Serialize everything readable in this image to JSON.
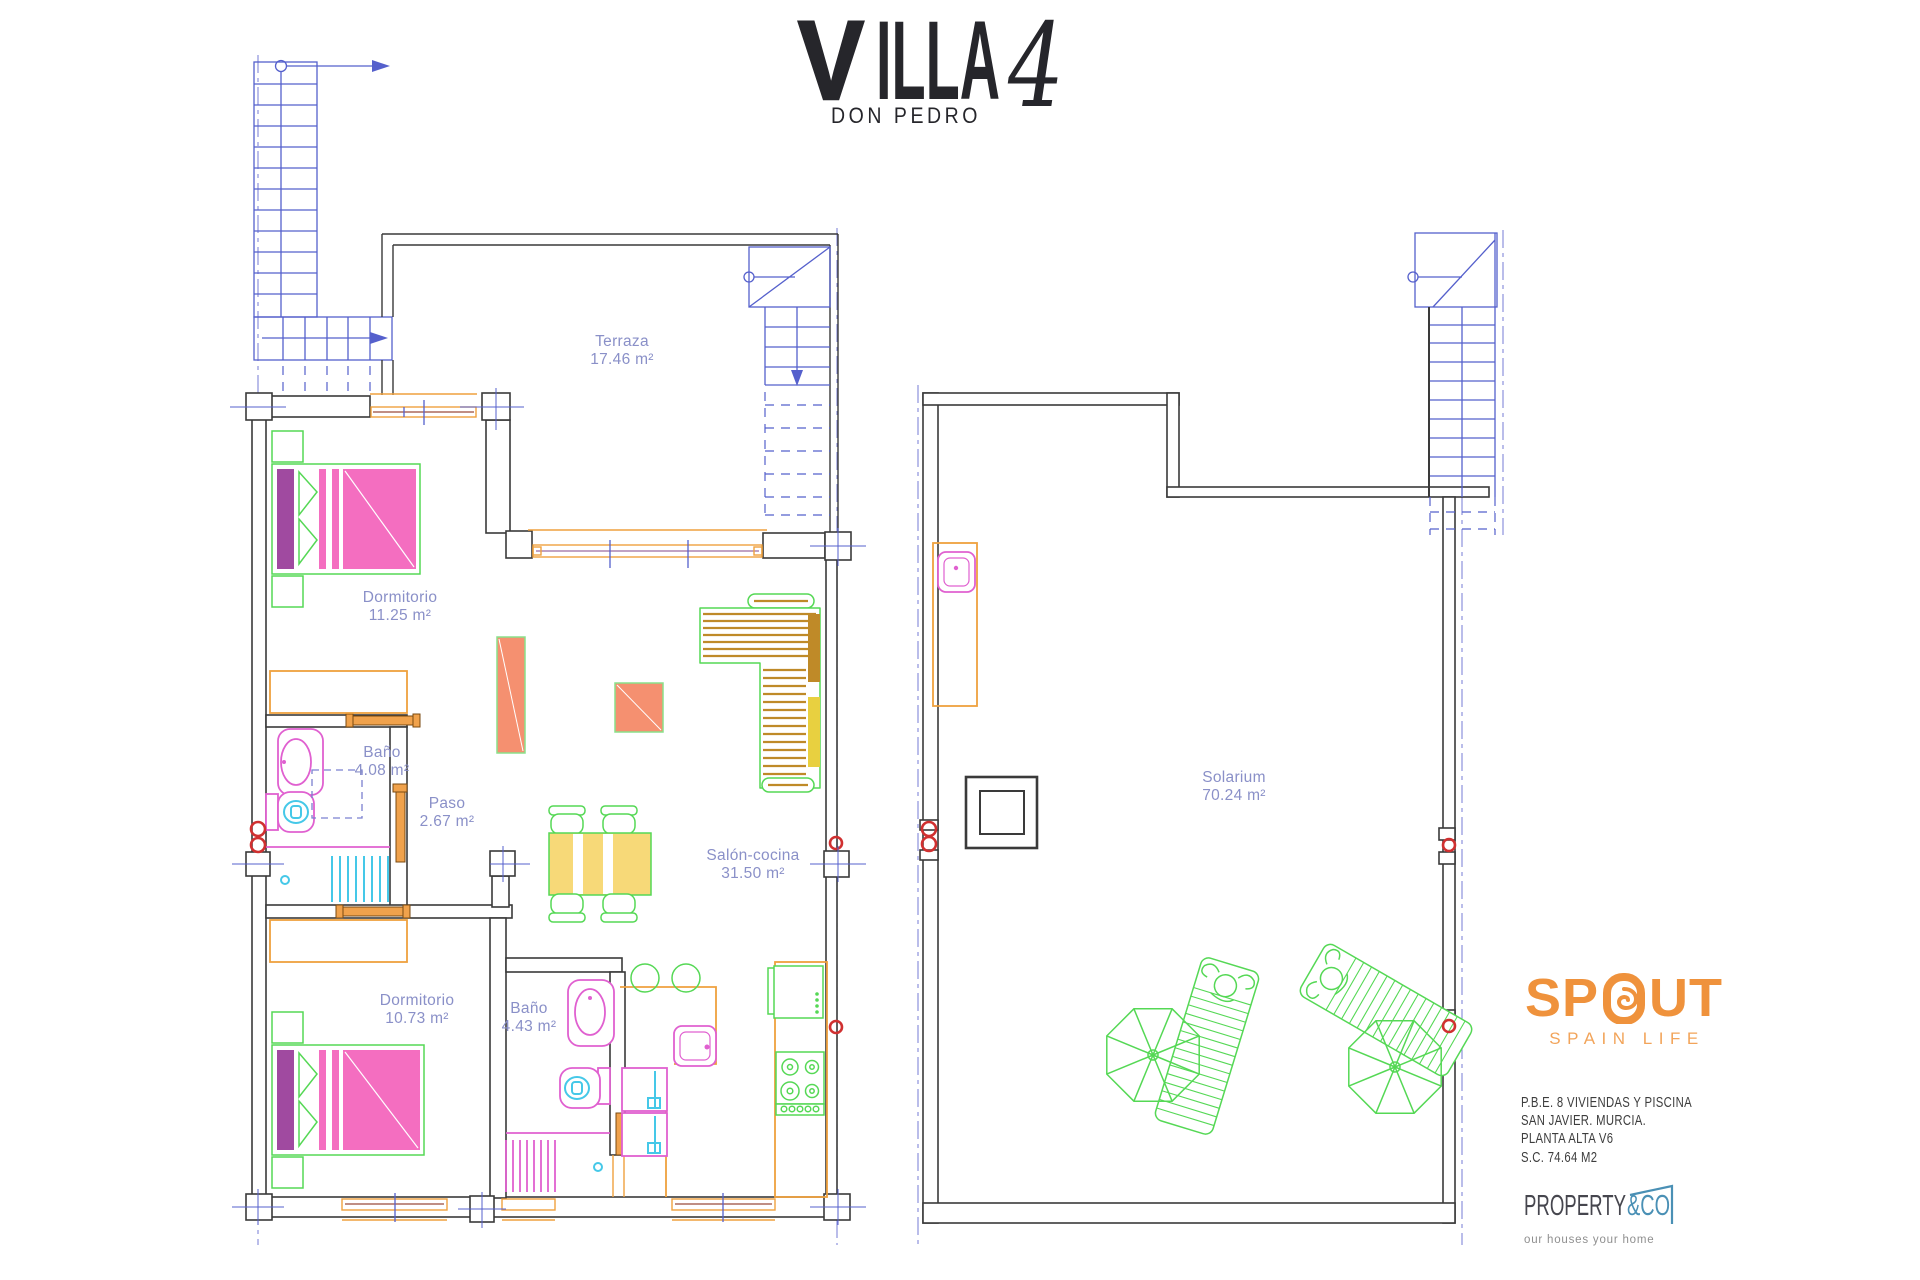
{
  "title": {
    "v": "V",
    "rest": "ILLA",
    "number": "4",
    "subtitle": "DON PEDRO"
  },
  "rooms": {
    "terraza": {
      "name": "Terraza",
      "area": "17.46 m²"
    },
    "dormitorio1": {
      "name": "Dormitorio",
      "area": "11.25 m²"
    },
    "bano1": {
      "name": "Baño",
      "area": "4.08 m²"
    },
    "paso": {
      "name": "Paso",
      "area": "2.67 m²"
    },
    "salon": {
      "name": "Salón-cocina",
      "area": "31.50 m²"
    },
    "dormitorio2": {
      "name": "Dormitorio",
      "area": "10.73 m²"
    },
    "bano2": {
      "name": "Baño",
      "area": "4.43 m²"
    },
    "solarium": {
      "name": "Solarium",
      "area": "70.24 m²"
    }
  },
  "branding": {
    "spout": {
      "name": "SPOUT",
      "left": "SP",
      "right": "UT",
      "tagline": "SPAIN LIFE"
    },
    "property": {
      "name": "PROPERTY",
      "suffix": "&CO",
      "tagline": "our houses your home"
    }
  },
  "project": {
    "lines": [
      "P.B.E. 8 VIVIENDAS Y PISCINA",
      "SAN JAVIER. MURCIA.",
      "PLANTA ALTA V6",
      "S.C. 74.64 M2"
    ]
  },
  "colors": {
    "wall": "#3a3a3a",
    "stair_blue": "#5560cc",
    "axis_blue": "#8287d8",
    "window_orange": "#efa13e",
    "door_orange": "#f0a24c",
    "marker_red": "#d03030",
    "furniture_green": "#55d855",
    "bed_pink": "#f46ec0",
    "headboard_purple": "#a04aa0",
    "fixture_magenta": "#e060d0",
    "fixture_cyan": "#45c8e8",
    "sofa_yellow": "#e8d040",
    "stripe_brown": "#bf8a28",
    "table_salmon": "#f59070",
    "label_blue": "#8a90c8",
    "spout_orange": "#ef923c",
    "property_blue": "#4a90b5",
    "text_dark": "#3d3d3d"
  }
}
